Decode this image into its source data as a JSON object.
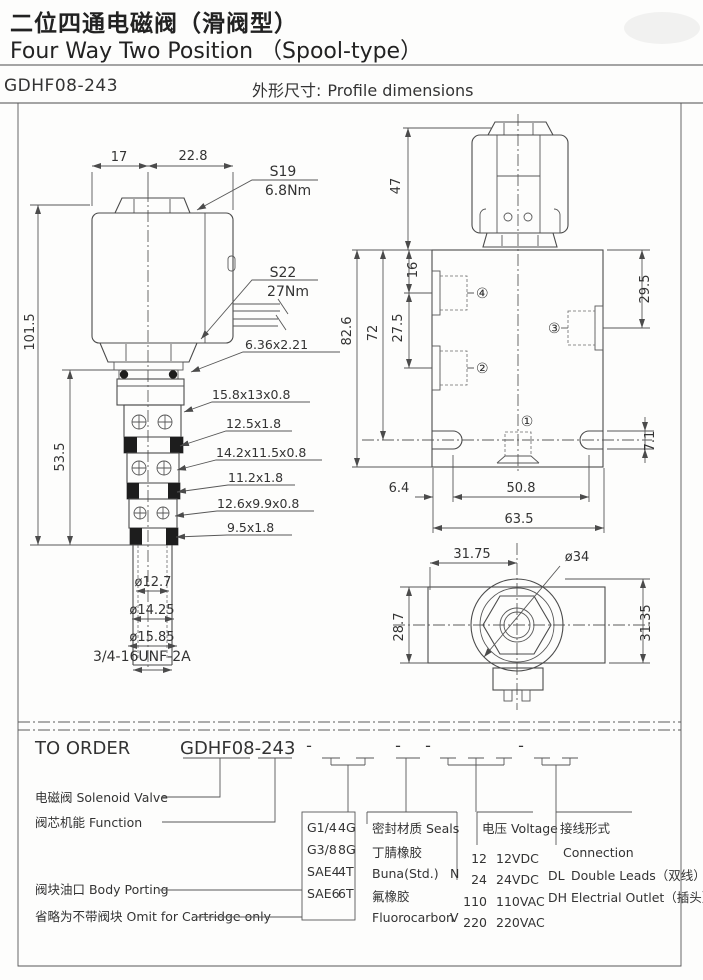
{
  "header": {
    "title_zh": "二位四通电磁阀（滑阀型）",
    "title_en": "Four Way Two Position （Spool-type）",
    "model": "GDHF08-243",
    "section_zh": "外形尺寸:",
    "section_en": "Profile dimensions"
  },
  "side_view": {
    "dim_width_left": "17",
    "dim_width_right": "22.8",
    "hex_top": "S19",
    "hex_top_torque": "6.8Nm",
    "hex_bottom": "S22",
    "hex_bottom_torque": "27Nm",
    "dim_height_total": "101.5",
    "dim_height_cartridge": "53.5",
    "seal_top": "6.36x2.21",
    "backup_ring_1": "15.8x13x0.8",
    "oring_1": "12.5x1.8",
    "backup_ring_2": "14.2x11.5x0.8",
    "oring_2": "11.2x1.8",
    "backup_ring_3": "12.6x9.9x0.8",
    "oring_3": "9.5x1.8",
    "dia_1": "ø12.7",
    "dia_2": "ø14.25",
    "dia_3": "ø15.85",
    "thread": "3/4-16UNF-2A"
  },
  "front_view": {
    "dim_coil_height": "47",
    "dim_port4_offset": "16",
    "dim_port_spacing": "27.5",
    "dim_height_72": "72",
    "dim_height_82_6": "82.6",
    "dim_port3_offset": "29.5",
    "dim_slot_height": "7.1",
    "dim_edge_to_hole": "6.4",
    "dim_hole_spacing": "50.8",
    "dim_body_width": "63.5",
    "port_1": "①",
    "port_2": "②",
    "port_3": "③",
    "port_4": "④"
  },
  "top_view": {
    "dim_center_offset": "31.75",
    "dia_coil": "ø34",
    "dim_body_height": "28.7",
    "dim_overall": "31.35"
  },
  "order": {
    "title": "TO ORDER",
    "model": "GDHF08-243",
    "dash": "-",
    "labels": {
      "solenoid": "电磁阀 Solenoid Valve",
      "function": "阀芯机能 Function",
      "porting": "阀块油口 Body Porting",
      "omit": "省略为不带阀块 Omit for Cartridge only"
    },
    "porting": {
      "rows": [
        {
          "name": "G1/4",
          "code": "4G"
        },
        {
          "name": "G3/8",
          "code": "8G"
        },
        {
          "name": "SAE4",
          "code": "4T"
        },
        {
          "name": "SAE6",
          "code": "6T"
        }
      ]
    },
    "seals": {
      "title": "密封材质 Seals",
      "rows": [
        {
          "zh": "丁腈橡胶",
          "en": "Buna(Std.)",
          "code": "N"
        },
        {
          "zh": "氟橡胶",
          "en": "Fluorocarbon",
          "code": "V"
        }
      ]
    },
    "voltage": {
      "title": "电压 Voltage",
      "rows": [
        {
          "code": "12",
          "name": "12VDC"
        },
        {
          "code": "24",
          "name": "24VDC"
        },
        {
          "code": "110",
          "name": "110VAC"
        },
        {
          "code": "220",
          "name": "220VAC"
        }
      ]
    },
    "connection": {
      "title_zh": "接线形式",
      "title_en": "Connection",
      "rows": [
        {
          "code": "DL",
          "name": "Double Leads（双线）"
        },
        {
          "code": "DH",
          "name": "Electrial Outlet（插头）"
        }
      ]
    }
  }
}
